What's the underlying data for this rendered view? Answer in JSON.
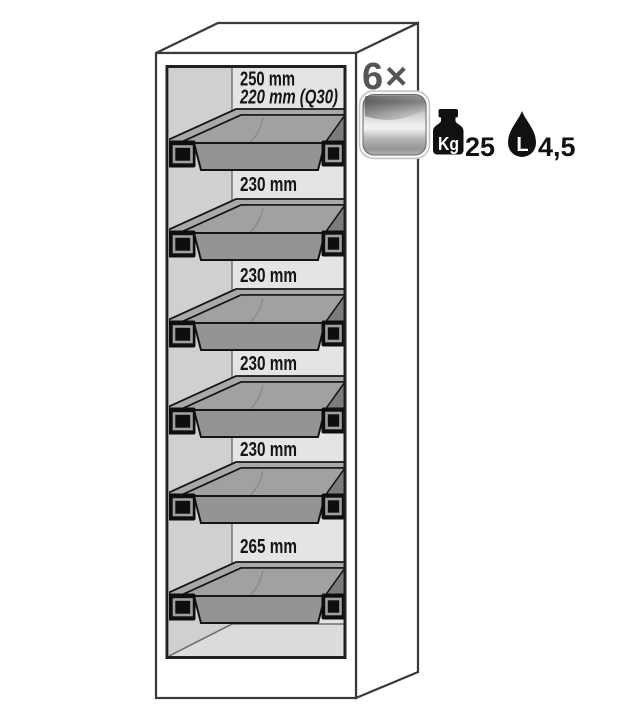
{
  "cabinet": {
    "description": "safety cabinet cutaway with pull-out trays",
    "tray_count": 6,
    "sections": [
      {
        "labels": [
          "250 mm",
          "220 mm (Q30)"
        ]
      },
      {
        "labels": [
          "230 mm"
        ]
      },
      {
        "labels": [
          "230 mm"
        ]
      },
      {
        "labels": [
          "230 mm"
        ]
      },
      {
        "labels": [
          "230 mm"
        ]
      },
      {
        "labels": [
          "265 mm"
        ]
      }
    ]
  },
  "legend": {
    "multiplier": "6×",
    "tray_icon": "metallic-tray-icon",
    "weight": {
      "icon": "weight-kg-icon",
      "unit": "Kg",
      "value": "25"
    },
    "volume": {
      "icon": "liquid-drop-icon",
      "unit": "L",
      "value": "4,5"
    }
  },
  "colors": {
    "outline": "#3a3a3a",
    "inner_frame": "#202020",
    "interior_left_wall": "#d0d0d0",
    "interior_back_wall": "#e4e4e4",
    "interior_floor": "#dcdcdc",
    "tray_rim": "#a9a9a9",
    "tray_front": "#949494",
    "bracket_black": "#0e0e0e",
    "multiplier_gray": "#565656",
    "pictogram_black": "#111111",
    "metal_highlight": "#efefef"
  }
}
